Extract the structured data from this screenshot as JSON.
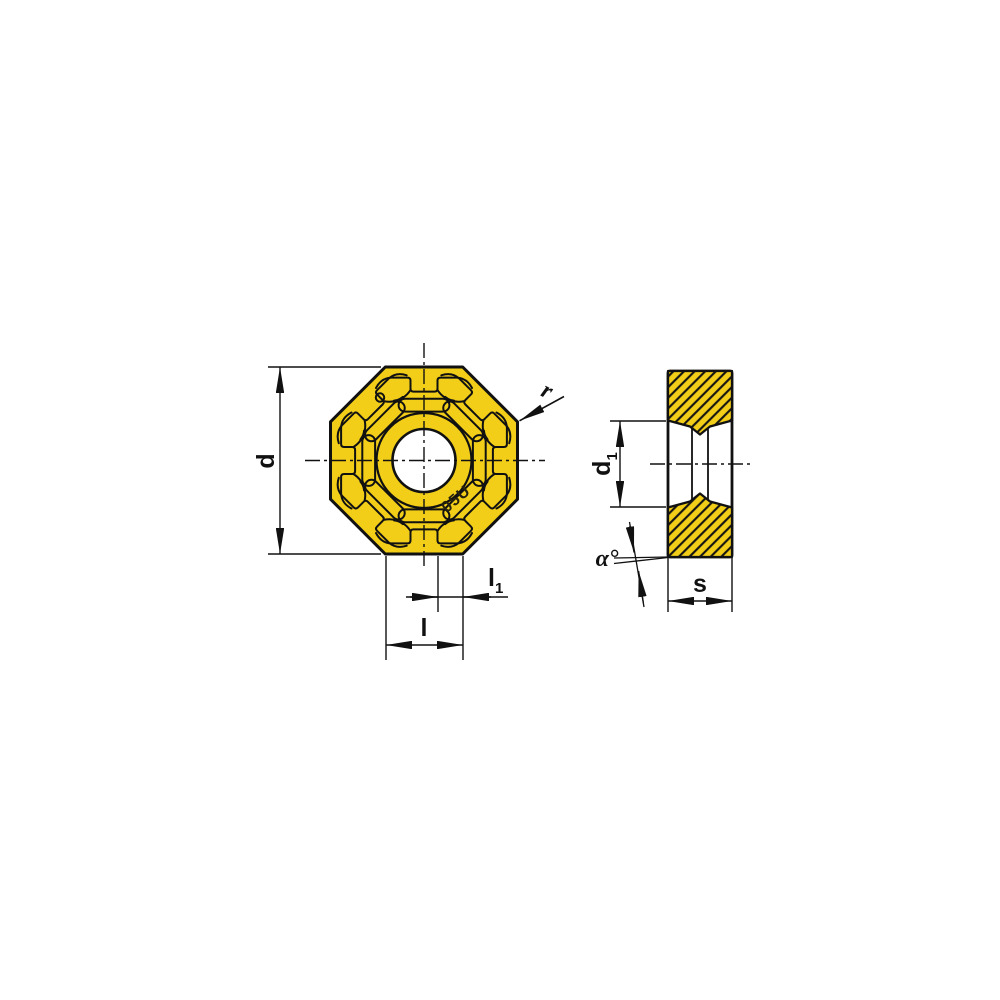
{
  "title": "Octagonal milling insert dimension drawing",
  "colors": {
    "insert_yellow": "#F2CE19",
    "line_black": "#111111",
    "background": "#FFFFFF"
  },
  "marking": "05U",
  "labels": {
    "d": "d",
    "r": "r",
    "l": "l",
    "l1": {
      "base": "l",
      "sub": "1"
    },
    "d1": {
      "base": "d",
      "sub": "1"
    },
    "alpha": "α°",
    "s": "s"
  }
}
